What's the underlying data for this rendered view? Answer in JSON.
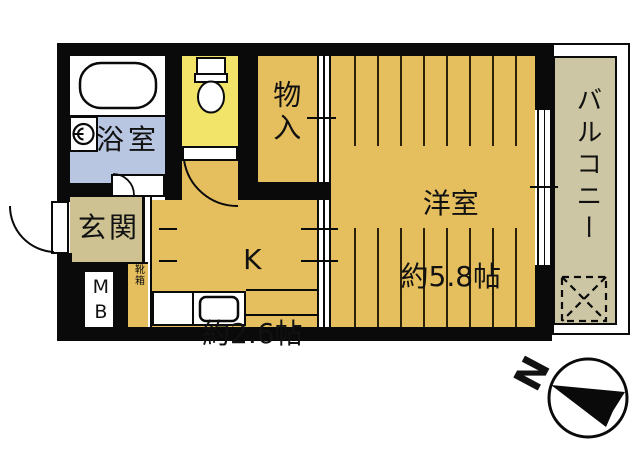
{
  "title": "apartment-floor-plan",
  "rooms": {
    "bathroom": {
      "label": "浴室"
    },
    "toilet": {
      "label": ""
    },
    "entrance": {
      "label": "玄関"
    },
    "meter_box": {
      "label": "MB"
    },
    "shoe_cabinet": {
      "label": "靴箱"
    },
    "kitchen": {
      "label": "K",
      "size": "約2.6帖"
    },
    "storage": {
      "label": "物入"
    },
    "western_room": {
      "label": "洋室",
      "size": "約5.8帖"
    },
    "balcony": {
      "label": "バルコニー"
    }
  },
  "compass": {
    "north_label": "N"
  },
  "colors": {
    "wall": "#0a0a0a",
    "room_floor_ochre": "#e5bf5e",
    "toilet_floor_yellow": "#f1e468",
    "bathroom_floor_blue": "#b9c6e2",
    "entrance_floor_beige": "#cec293",
    "balcony_floor_tan": "#cdc6a4",
    "background": "#ffffff"
  },
  "icons": {
    "bathtub": "bathtub-icon",
    "washing_machine": "washing-machine-icon",
    "toilet": "toilet-icon",
    "kitchen_sink": "sink-icon",
    "laundry_space": "laundry-space-icon",
    "compass_needle": "compass-north-icon"
  }
}
